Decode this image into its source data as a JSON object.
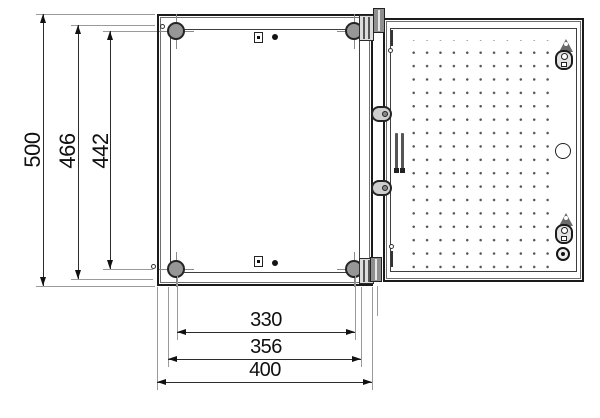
{
  "drawing": {
    "type": "technical-drawing",
    "unit": "mm",
    "subject": "wall-mount enclosure: front view (left) and open view with perforated mounting plate (right)",
    "colors": {
      "background": "#ffffff",
      "outline": "#1a1a1a",
      "dimension_line": "#2b2b2b",
      "extension_line": "#9a9a9a",
      "metal_fill": "#969696"
    },
    "dimensions": {
      "vertical": [
        {
          "id": "overall-height",
          "label": "500"
        },
        {
          "id": "fixing-height-outer",
          "label": "466"
        },
        {
          "id": "fixing-hole-centres-height",
          "label": "442"
        }
      ],
      "horizontal": [
        {
          "id": "fixing-hole-centres-width",
          "label": "330"
        },
        {
          "id": "fixing-width-outer",
          "label": "356"
        },
        {
          "id": "overall-width",
          "label": "400"
        }
      ]
    }
  }
}
